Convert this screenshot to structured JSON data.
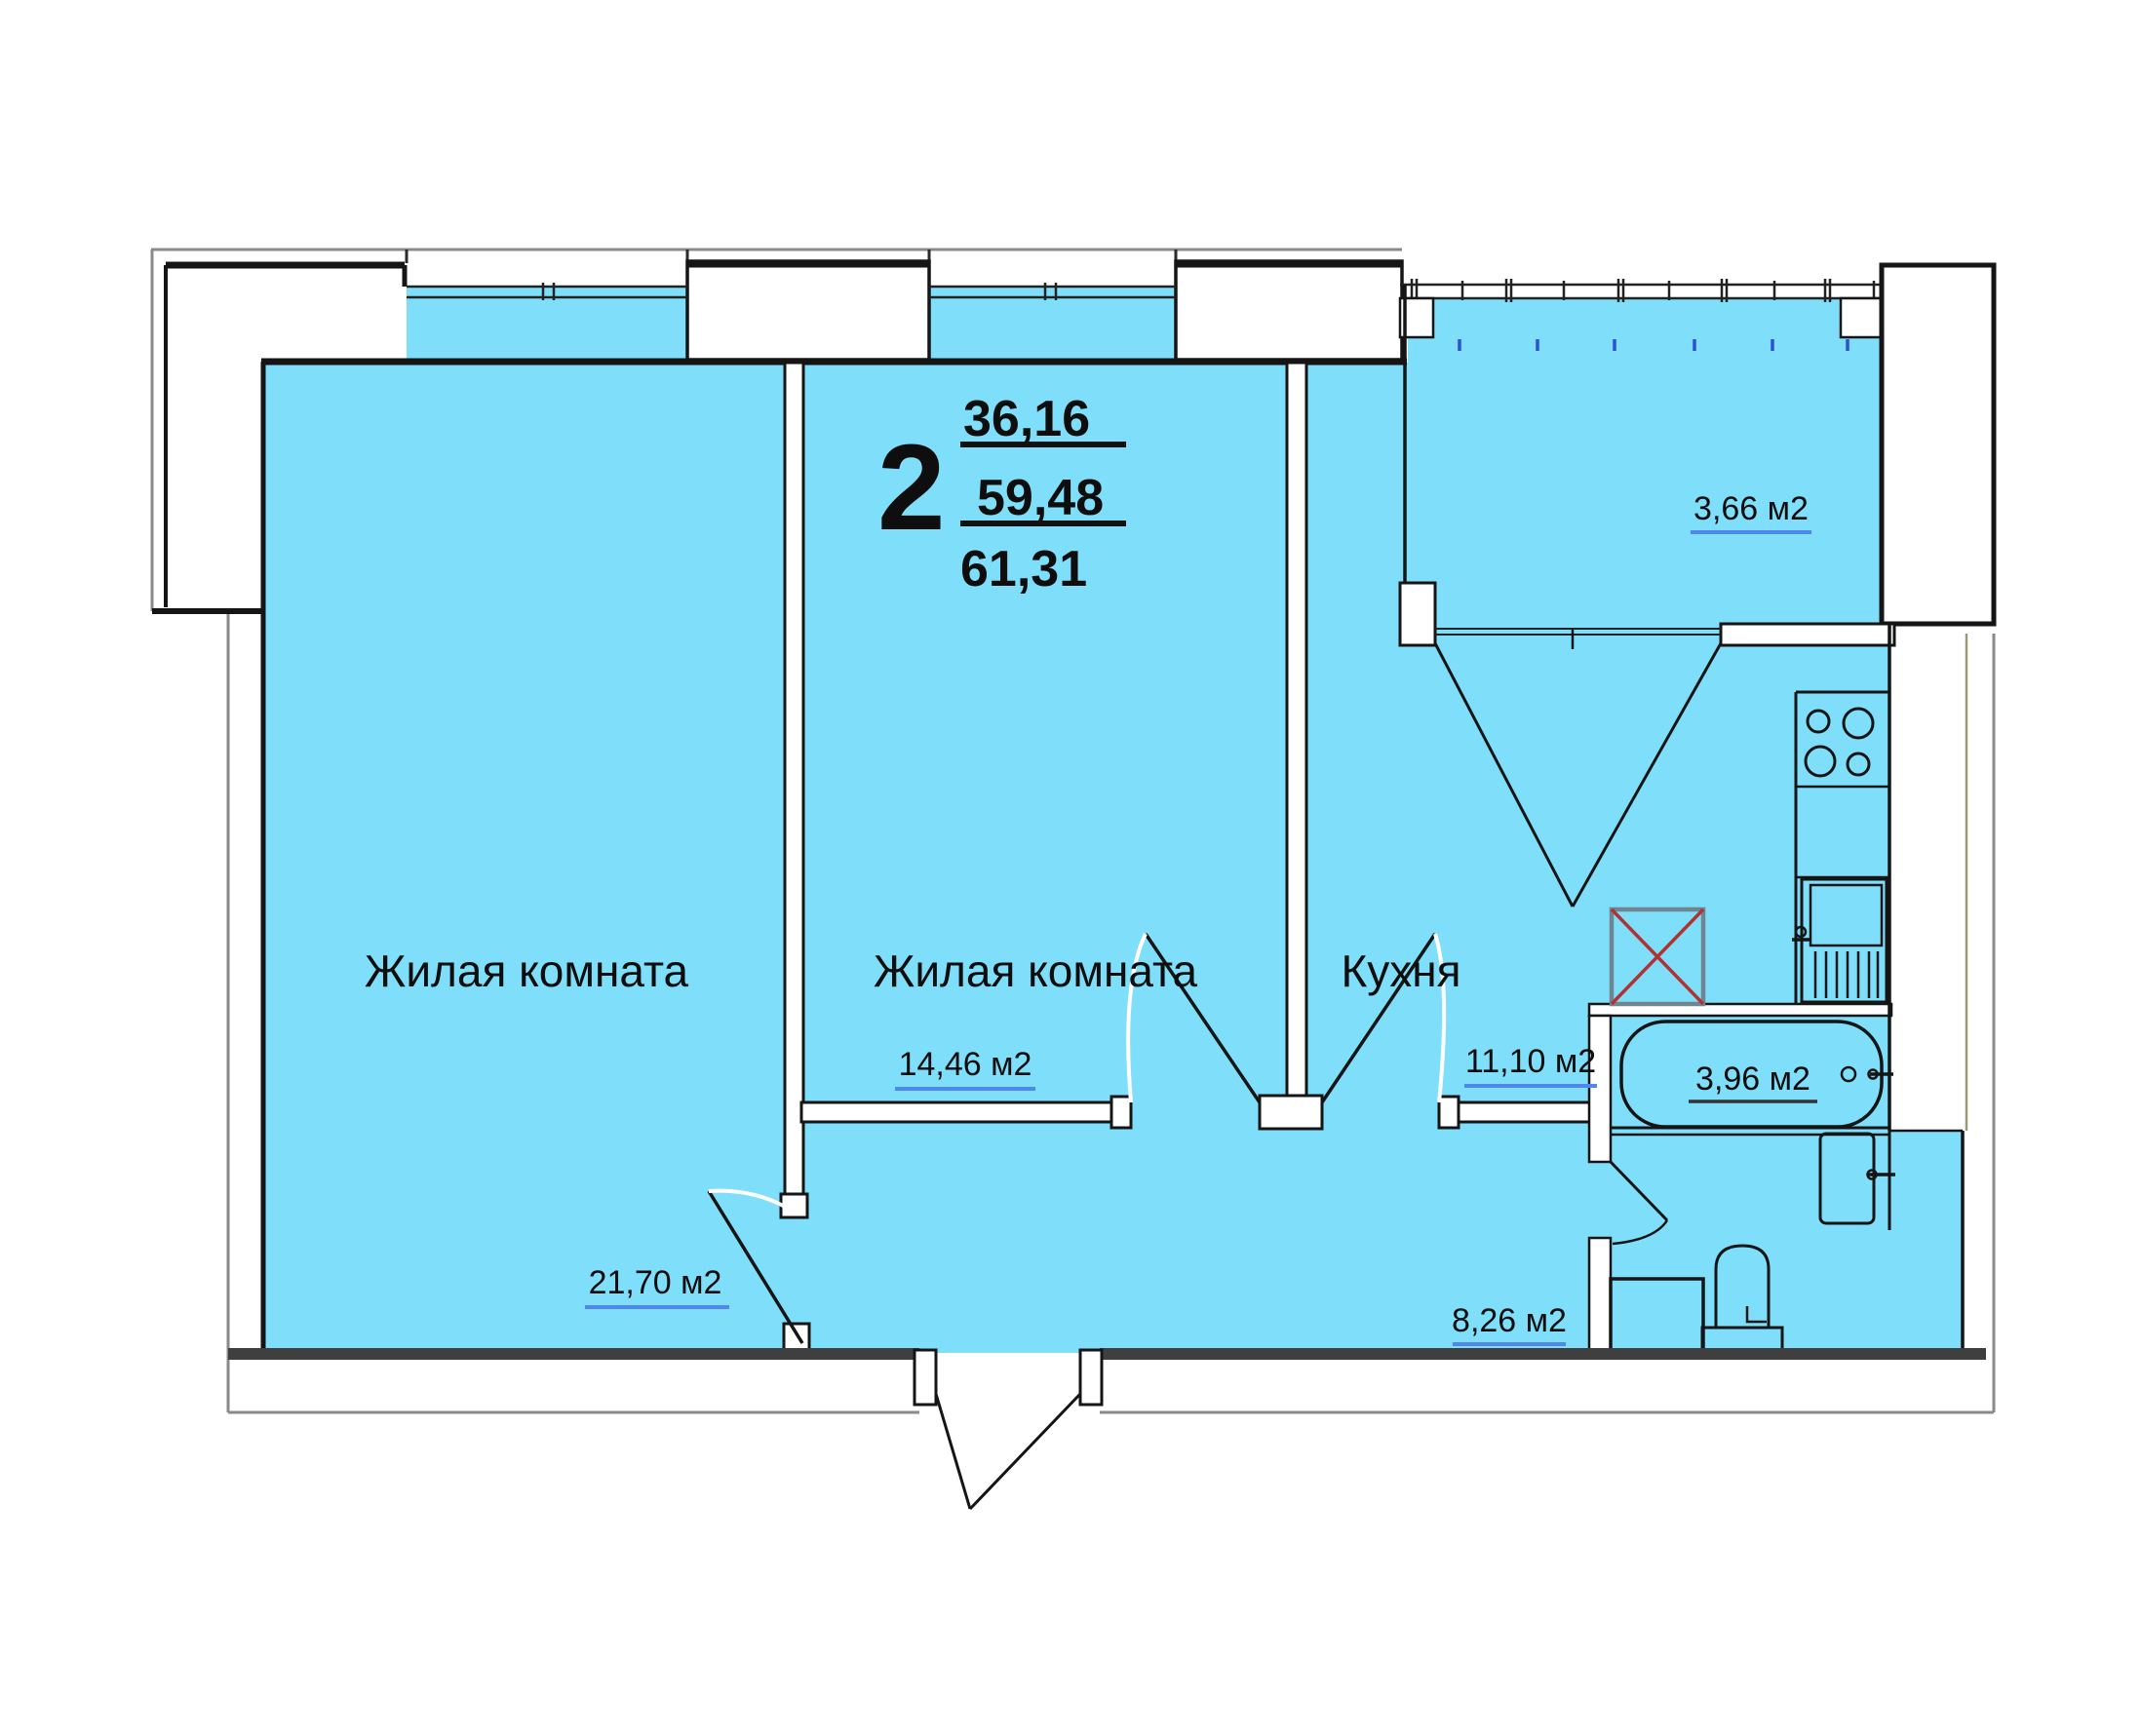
{
  "plan": {
    "type_label": "2",
    "areas": {
      "living": "36,16",
      "reduced": "59,48",
      "total": "61,31"
    },
    "rooms": [
      {
        "name": "Жилая комната",
        "area": "21,70 м2"
      },
      {
        "name": "Жилая комната",
        "area": "14,46 м2"
      },
      {
        "name": "Кухня",
        "area": "11,10 м2"
      },
      {
        "area": "8,26 м2"
      },
      {
        "area": "3,96 м2"
      },
      {
        "area": "3,66 м2"
      }
    ],
    "colors": {
      "room_fill": "#7FDFFB",
      "wall": "#151515",
      "outer_line": "#8A8A8A",
      "area_underline": "#4F86EF",
      "vent_cross": "#B03232",
      "balcony_tick": "#2B52D6",
      "bottom_wall": "#3F3F3F"
    }
  }
}
